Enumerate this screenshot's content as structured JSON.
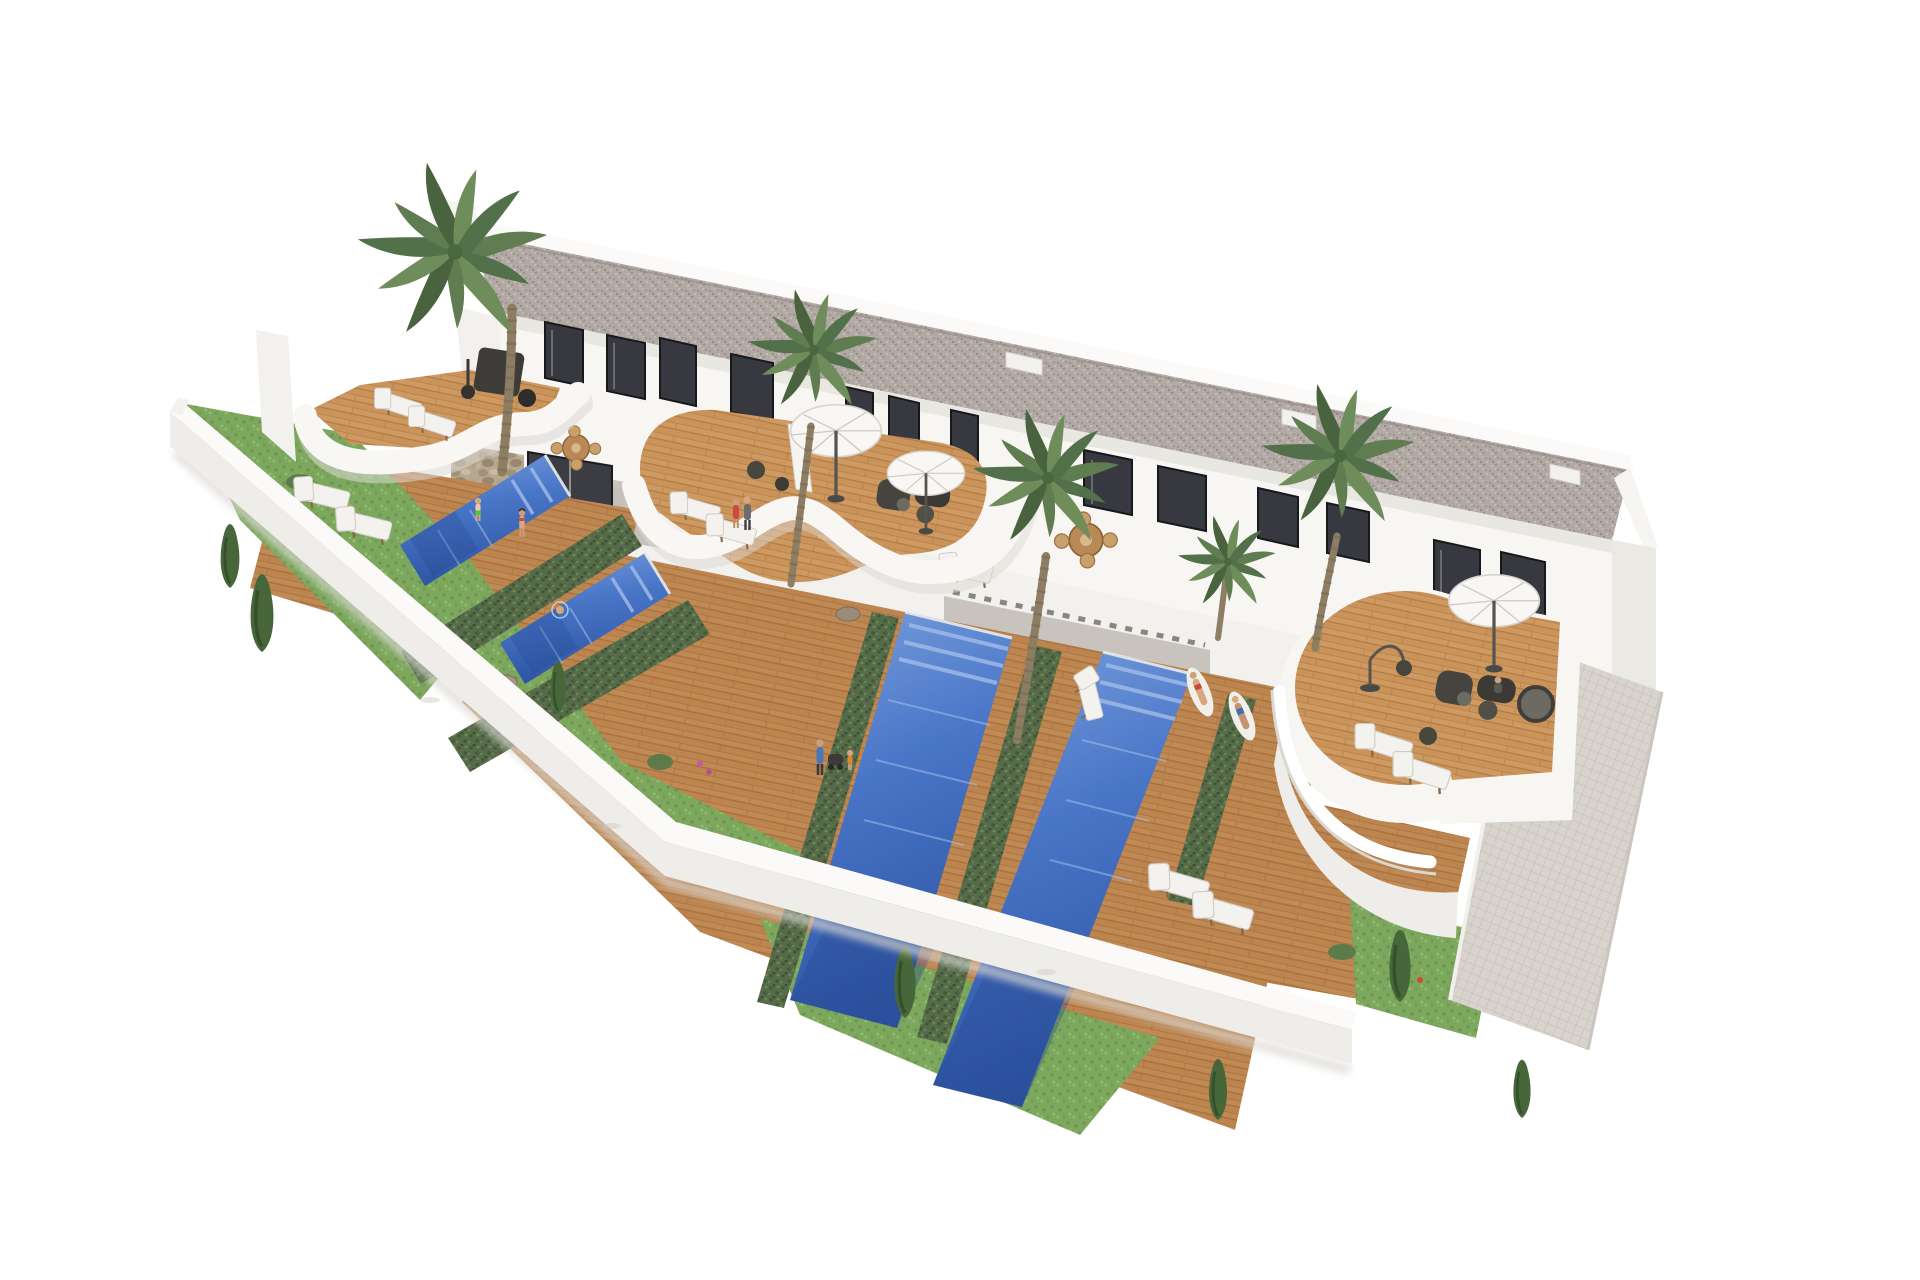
{
  "scene": {
    "type": "architectural-3d-render",
    "subject": "high-angle aerial rendering of a row of modern two-storey white villas with curved roof terraces, private pools, timber decks, palm trees and a walled garden",
    "view": "three-quarter aerial, building receding to the lower right, pure white background",
    "counts": {
      "pools": 4,
      "umbrellas": 3,
      "palm_trees": 5,
      "sun_loungers": 12,
      "roof_terraces": 4,
      "privacy_hedges": 5,
      "conifer_trees": 7,
      "people": 10,
      "dining_sets": 2,
      "stone_feature_walls": 3
    },
    "features": [
      "gravel flat roof",
      "white stucco facades with dark glazing",
      "curved white balcony fascias",
      "private plunge pools",
      "timber decking",
      "privacy hedges between plots",
      "white perimeter wall",
      "mosaic tiled walkway"
    ],
    "palette": {
      "background": "#ffffff",
      "wall_white": "#f7f6f3",
      "wall_bright": "#fbfaf8",
      "wall_face": "#efede9",
      "wall_shade": "#e2dfda",
      "roof_gravel": "#b2a9a5",
      "roof_gravel_dark": "#948b87",
      "window_glass": "#383940",
      "window_frame": "#17181b",
      "deck_wood": "#c08a55",
      "deck_wood_dark": "#a8713d",
      "deck_wood_light": "#cf9a62",
      "pool_water": "#4a76c8",
      "pool_water_deep": "#2d54a3",
      "pool_water_light": "#7aa0dc",
      "pool_steps": "#9db9e6",
      "hedge_green": "#566b49",
      "hedge_green_dark": "#44573a",
      "grass_green": "#7ca75d",
      "conifer_green": "#47663a",
      "palm_green": "#5f7d50",
      "palm_trunk": "#8d7d62",
      "stone_beige": "#b7a78f",
      "umbrella_white": "#f8f7f4",
      "furniture_dark": "#46453f",
      "lounger_white": "#f3f2ee",
      "tile_path": "#d8d3cc",
      "tile_line": "#c1bbb3",
      "shadow_soft": "#dcd9d4"
    }
  }
}
